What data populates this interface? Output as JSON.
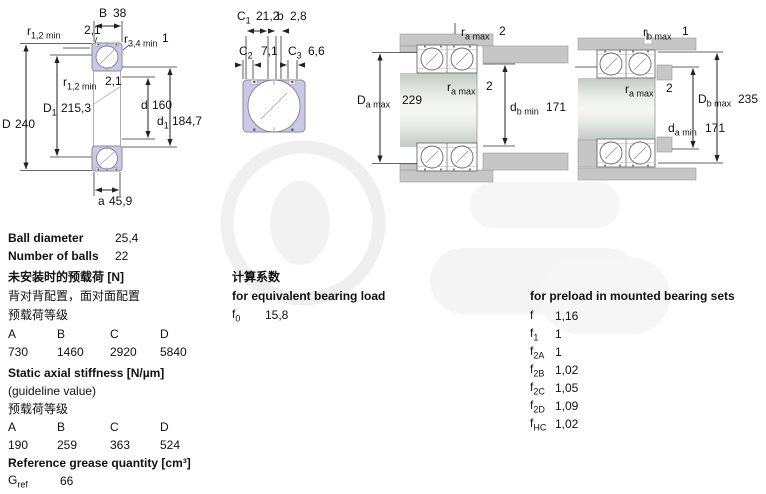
{
  "diagram1": {
    "B": {
      "base": "B",
      "sub": "",
      "value": "38"
    },
    "r12_top": {
      "base": "r",
      "sub": "1,2 min",
      "value": "2,1"
    },
    "r34": {
      "base": "r",
      "sub": "3,4 min",
      "value": "1"
    },
    "r12_mid": {
      "base": "r",
      "sub": "1,2 min",
      "value": "2,1"
    },
    "D1": {
      "base": "D",
      "sub": "1",
      "value": "215,3"
    },
    "d": {
      "base": "d",
      "sub": "",
      "value": "160"
    },
    "D": {
      "base": "D",
      "sub": "",
      "value": "240"
    },
    "d1": {
      "base": "d",
      "sub": "1",
      "value": "184,7"
    },
    "a": {
      "base": "a",
      "sub": "",
      "value": "45,9"
    }
  },
  "diagram2": {
    "C1": {
      "base": "C",
      "sub": "1",
      "value": "21,2"
    },
    "b": {
      "base": "b",
      "sub": "",
      "value": "2,8"
    },
    "C2": {
      "base": "C",
      "sub": "2",
      "value": "7,1"
    },
    "C3": {
      "base": "C",
      "sub": "3",
      "value": "6,6"
    }
  },
  "diagram3": {
    "ra_top": {
      "base": "r",
      "sub": "a max",
      "value": "2"
    },
    "ra_mid": {
      "base": "r",
      "sub": "a max",
      "value": "2"
    },
    "Da_max": {
      "base": "D",
      "sub": "a max",
      "value": "229"
    },
    "db_min": {
      "base": "d",
      "sub": "b min",
      "value": "171"
    }
  },
  "diagram4": {
    "rb_max": {
      "base": "r",
      "sub": "b max",
      "value": "1"
    },
    "ra_max": {
      "base": "r",
      "sub": "a max",
      "value": "2"
    },
    "Db_max": {
      "base": "D",
      "sub": "b max",
      "value": "235"
    },
    "da_min": {
      "base": "d",
      "sub": "a min",
      "value": "171"
    }
  },
  "specs": {
    "ball_diameter_label": "Ball diameter",
    "ball_diameter_value": "25,4",
    "number_of_balls_label": "Number of balls",
    "number_of_balls_value": "22"
  },
  "preload_unmounted": {
    "title": "未安装时的预载荷 [N]",
    "subtitle": "背对背配置，面对面配置",
    "class_label": "预载荷等级",
    "cols": [
      "A",
      "B",
      "C",
      "D"
    ],
    "values": [
      "730",
      "1460",
      "2920",
      "5840"
    ]
  },
  "calc_factors": {
    "title": "计算系数",
    "subtitle": "for equivalent bearing load",
    "f0": {
      "base": "f",
      "sub": "0",
      "value": "15,8"
    }
  },
  "preload_factors": {
    "title": "for preload in mounted bearing sets",
    "rows": [
      {
        "base": "f",
        "sub": "",
        "value": "1,16"
      },
      {
        "base": "f",
        "sub": "1",
        "value": "1"
      },
      {
        "base": "f",
        "sub": "2A",
        "value": "1"
      },
      {
        "base": "f",
        "sub": "2B",
        "value": "1,02"
      },
      {
        "base": "f",
        "sub": "2C",
        "value": "1,05"
      },
      {
        "base": "f",
        "sub": "2D",
        "value": "1,09"
      },
      {
        "base": "f",
        "sub": "HC",
        "value": "1,02"
      }
    ]
  },
  "stiffness": {
    "title": "Static axial stiffness [N/µm]",
    "subtitle": "(guideline value)",
    "class_label": "预载荷等级",
    "cols": [
      "A",
      "B",
      "C",
      "D"
    ],
    "values": [
      "190",
      "259",
      "363",
      "524"
    ]
  },
  "grease": {
    "title": "Reference grease quantity [cm³]",
    "gref": {
      "base": "G",
      "sub": "ref",
      "value": "66"
    }
  }
}
